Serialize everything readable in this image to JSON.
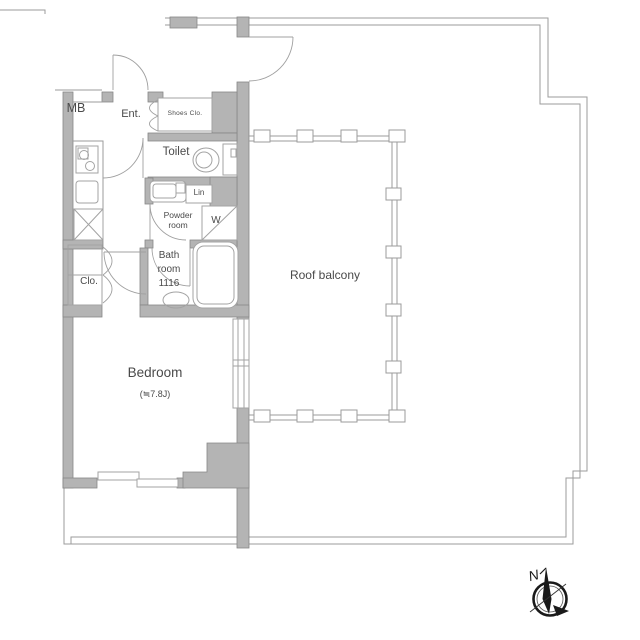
{
  "floorplan": {
    "labels": {
      "mb": "MB",
      "entrance": "Ent.",
      "shoes_closet": "Shoes Clo.",
      "toilet": "Toilet",
      "linen": "Lin",
      "powder_line1": "Powder",
      "powder_line2": "room",
      "washer": "W",
      "bath_line1": "Bath",
      "bath_line2": "room",
      "bath_line3": "1116",
      "closet": "Clo.",
      "bedroom": "Bedroom",
      "bedroom_size": "(≒7.8J)",
      "roof_balcony": "Roof balcony",
      "compass_north": "N"
    },
    "colors": {
      "wall_fill": "#b4b4b4",
      "wall_stroke": "#878787",
      "line": "#9b9b9b",
      "fixture_stroke": "#a3a3a3",
      "text": "#4a4a4a",
      "accent_black": "#1a1a1a",
      "background": "#ffffff"
    }
  }
}
